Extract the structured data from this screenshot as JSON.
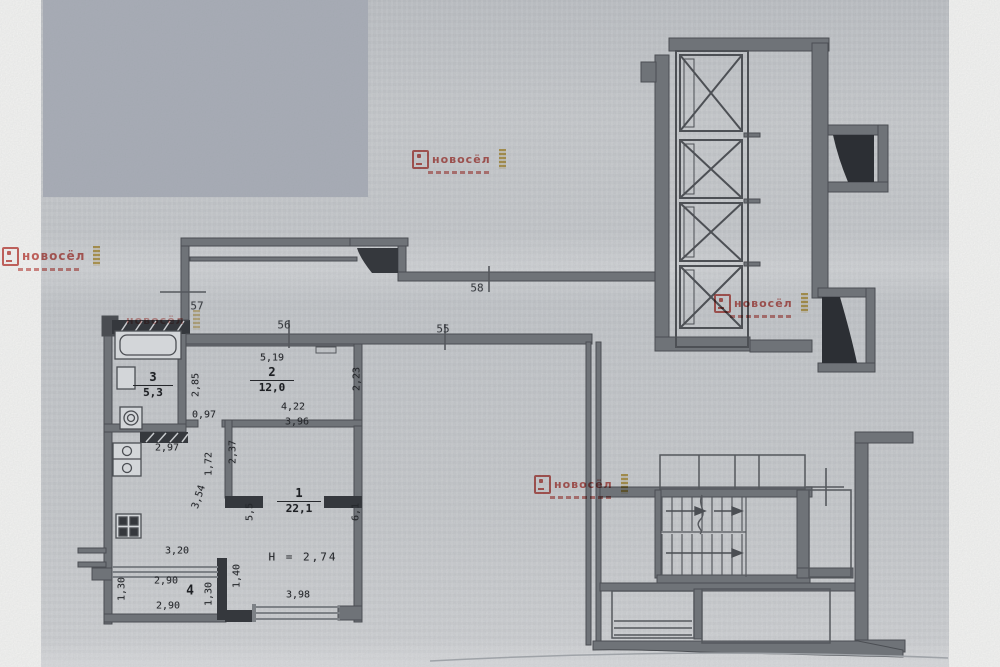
{
  "document": {
    "type": "scanned apartment floor plan"
  },
  "watermark": {
    "text": "новосёл"
  },
  "colors": {
    "censor": "#a9aeb8",
    "paper": "#c7cacd",
    "wall": "#6f7378",
    "wall_dark": "#35383d",
    "line": "#4b4e53",
    "watermark_red": "#c2423c",
    "watermark_gold": "#c9a23a"
  },
  "axes": {
    "a55": "55",
    "a56": "56",
    "a57": "57",
    "a58": "58"
  },
  "rooms": {
    "r1": {
      "num": "1",
      "area": "22,1"
    },
    "r2": {
      "num": "2",
      "area": "12,0"
    },
    "r3": {
      "num": "3",
      "area": "5,3"
    },
    "r4": {
      "num": "4"
    }
  },
  "height_note": "H = 2,74",
  "dims": {
    "w519": "5,19",
    "h285": "2,85",
    "h223": "2,23",
    "w422": "4,22",
    "w396": "3,96",
    "w097": "0,97",
    "w297": "2,97",
    "h237": "2,37",
    "h172": "1,72",
    "d354": "3,54",
    "h55": "5,5",
    "h61": "6,1",
    "w398": "3,98",
    "h140": "1,40",
    "w320": "3,20",
    "w290a": "2,90",
    "w290b": "2,90",
    "h130a": "1,30",
    "h130b": "1,30"
  }
}
